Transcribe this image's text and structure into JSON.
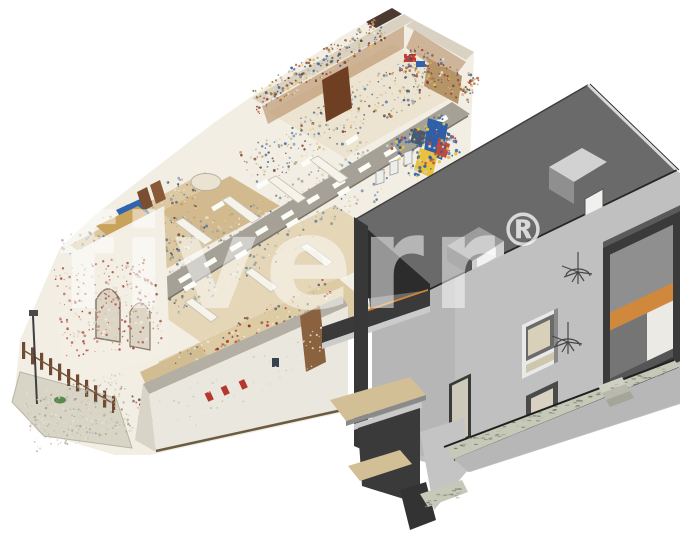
{
  "watermark": {
    "text": "fiverr",
    "registered": "®",
    "color": "#ffffff",
    "opacity": "0.5"
  },
  "colors": {
    "background": "#ffffff",
    "bim": {
      "roof": "#6a6a6a",
      "roof_cut": "#2c2c2c",
      "wall": "#c0c0c0",
      "wall_lower": "#b7b7b7",
      "cut_dark": "#3a3a3a",
      "slab_underside": "#cbcbcb",
      "floor": "#d3bf95",
      "wood": "#d0883c",
      "stone": "#c6c8b8",
      "frame_light": "#e9e9e9",
      "edge_line": "#202020",
      "stone_dash": [
        "#70756a",
        "#9aa091",
        "#b8bcae",
        "#878c7e"
      ]
    },
    "cloud": {
      "base": "#f2eee3",
      "wall": "#f3efe5",
      "floor": "#ddcba4",
      "floor2": "#e4d6b6",
      "corridor": "#a6a196",
      "cap": "#b3afa4",
      "shelf": "#b08458",
      "cabinet": "#6e3f22",
      "brick": "#b2584a",
      "gravel": "#d8d4c6",
      "fence": "#6f4a33",
      "light_rect": "#fdfdf8",
      "palette_warm": [
        "#e7dcc2",
        "#dbc9a2",
        "#cdb98e",
        "#f0e9d8",
        "#c3ad82"
      ],
      "palette_shelf": [
        "#8a5c36",
        "#6f4428",
        "#a97c4f",
        "#c8b089",
        "#b23a30",
        "#3f66a8",
        "#e0c45a",
        "#efe8da"
      ],
      "palette_room": [
        "#efe9da",
        "#ded2b6",
        "#b9b2a2",
        "#8c9aa8",
        "#4a74b0",
        "#7a93b8",
        "#5a6a7a",
        "#c8bfa8",
        "#97a08f",
        "#e5dcc6"
      ],
      "palette_office": [
        "#e5d9bd",
        "#4a74b0",
        "#7a93b8",
        "#caa05a",
        "#7a5036",
        "#efe9dc",
        "#b5aa92",
        "#55606e"
      ],
      "palette_mural": [
        "#3f66a8",
        "#e8c23c",
        "#c04a3e",
        "#d8d0c0",
        "#4a5a6c",
        "#2f5fa8"
      ],
      "palette_brick": [
        "#b2584a",
        "#c97f6e",
        "#e8ddd0",
        "#f3ece1",
        "#9a4a3c",
        "#d8c9ba"
      ],
      "palette_gravel": [
        "#c9c5b6",
        "#b5b1a2",
        "#dcd8ca",
        "#a39f90",
        "#e5e1d4"
      ],
      "palette_lower": [
        "#e9e3d4",
        "#d9c9a6",
        "#c23b32",
        "#8a2f28",
        "#55606e",
        "#a89a7e",
        "#7a5a3a",
        "#efeade"
      ],
      "palette_wallface": [
        "#efece2",
        "#ddd8ca",
        "#c9c4b4"
      ]
    }
  }
}
